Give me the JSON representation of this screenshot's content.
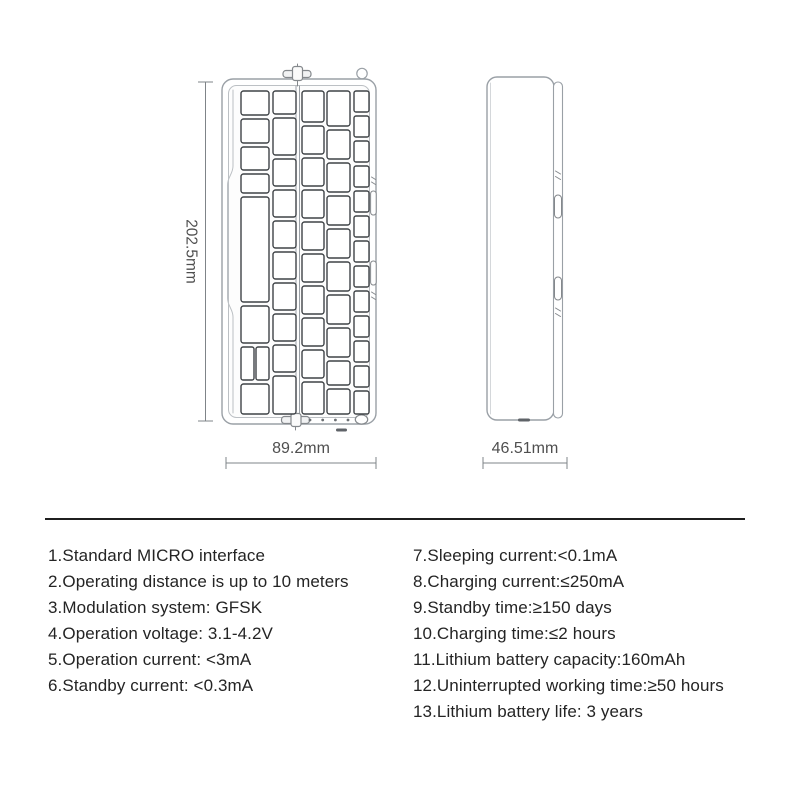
{
  "drawing": {
    "front_view": {
      "height_label": "202.5mm",
      "width_label": "89.2mm"
    },
    "side_view": {
      "width_label": "46.51mm"
    }
  },
  "specs": {
    "left": [
      "1.Standard MICRO interface",
      "2.Operating distance is up to 10 meters",
      "3.Modulation system: GFSK",
      "4.Operation voltage: 3.1-4.2V",
      "5.Operation current: <3mA",
      "6.Standby current: <0.3mA"
    ],
    "right": [
      "7.Sleeping current:<0.1mA",
      "8.Charging current:≤250mA",
      "9.Standby time:≥150 days",
      "10.Charging time:≤2 hours",
      "11.Lithium battery capacity:160mAh",
      "12.Uninterrupted working time:≥50 hours",
      "13.Lithium battery life: 3 years"
    ]
  },
  "colors": {
    "body_outline": "#9aa0a6",
    "key_outline": "#3f4347",
    "dimension_line": "#7f8488",
    "dimension_text": "#4f4f4f",
    "spec_text": "#242424",
    "divider": "#1f1f1f",
    "background": "#ffffff"
  }
}
